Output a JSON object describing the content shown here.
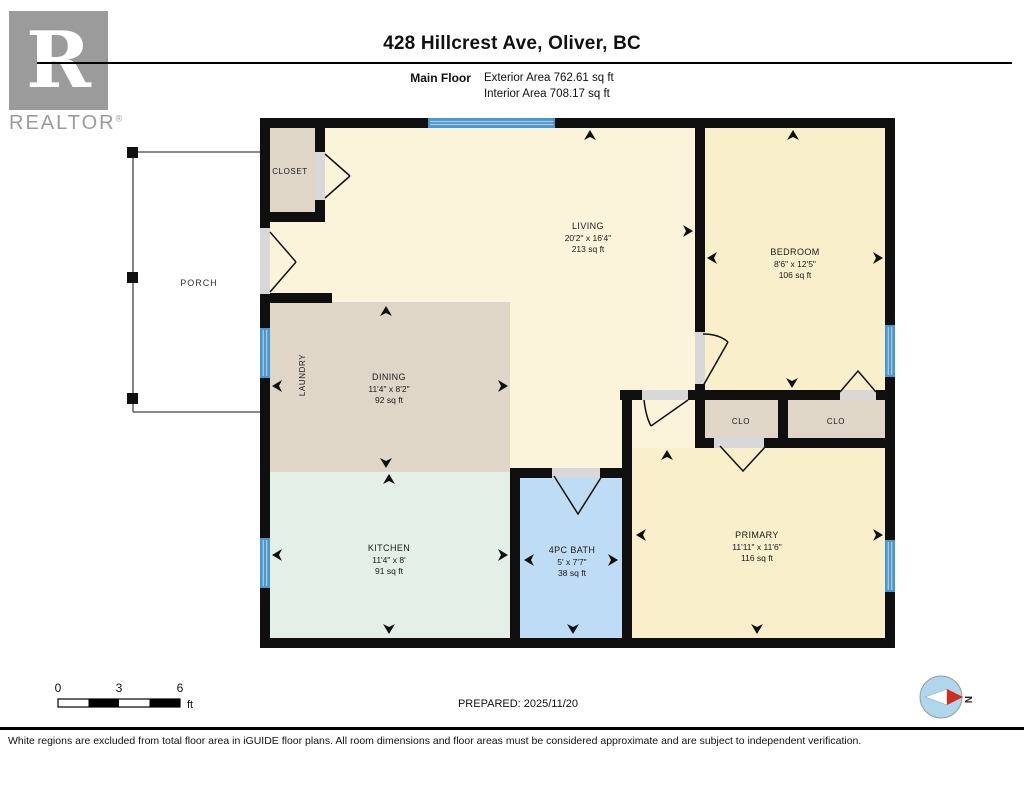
{
  "header": {
    "title": "428 Hillcrest Ave, Oliver, BC",
    "floor_label": "Main Floor",
    "exterior_area": "Exterior Area 762.61 sq ft",
    "interior_area": "Interior Area 708.17 sq ft"
  },
  "logo": {
    "letter": "R",
    "brand": "REALTOR",
    "registered": "®"
  },
  "rooms": {
    "living": {
      "name": "LIVING",
      "dims": "20'2\" x 16'4\"",
      "area": "213 sq ft"
    },
    "bedroom": {
      "name": "BEDROOM",
      "dims": "8'6\" x 12'5\"",
      "area": "106 sq ft"
    },
    "dining": {
      "name": "DINING",
      "dims": "11'4\" x 8'2\"",
      "area": "92 sq ft"
    },
    "kitchen": {
      "name": "KITCHEN",
      "dims": "11'4\" x 8'",
      "area": "91 sq ft"
    },
    "bath": {
      "name": "4PC BATH",
      "dims": "5' x 7'7\"",
      "area": "38 sq ft"
    },
    "primary": {
      "name": "PRIMARY",
      "dims": "11'11\" x 11'6\"",
      "area": "116 sq ft"
    },
    "laundry": {
      "name": "LAUNDRY"
    },
    "closet": {
      "name": "CLOSET"
    },
    "clo_left": {
      "name": "CLO"
    },
    "clo_right": {
      "name": "CLO"
    },
    "porch": {
      "name": "PORCH"
    }
  },
  "scale_bar": {
    "tick0": "0",
    "tick1": "3",
    "tick2": "6",
    "unit": "ft"
  },
  "prepared": "PREPARED: 2025/11/20",
  "compass": {
    "north_label": "N"
  },
  "footer": {
    "disclaimer": "White regions are excluded from total floor area in iGUIDE floor plans. All room dimensions and floor areas must be considered approximate and are subject to independent verification."
  },
  "colors": {
    "wall": "#0f0f0f",
    "cream_room": "#FCF4DA",
    "yellow_room": "#FAEFCB",
    "tan_room": "#DFD6C7",
    "kitchen_mint": "#E4EFE8",
    "bath_blue": "#BEDCF4",
    "window_blue": "#4D96CB",
    "door_opening": "#D8D8D8",
    "logo_gray": "#9B9B9B",
    "compass_fill": "#AED7EE",
    "compass_needle_red": "#D42B1E"
  }
}
